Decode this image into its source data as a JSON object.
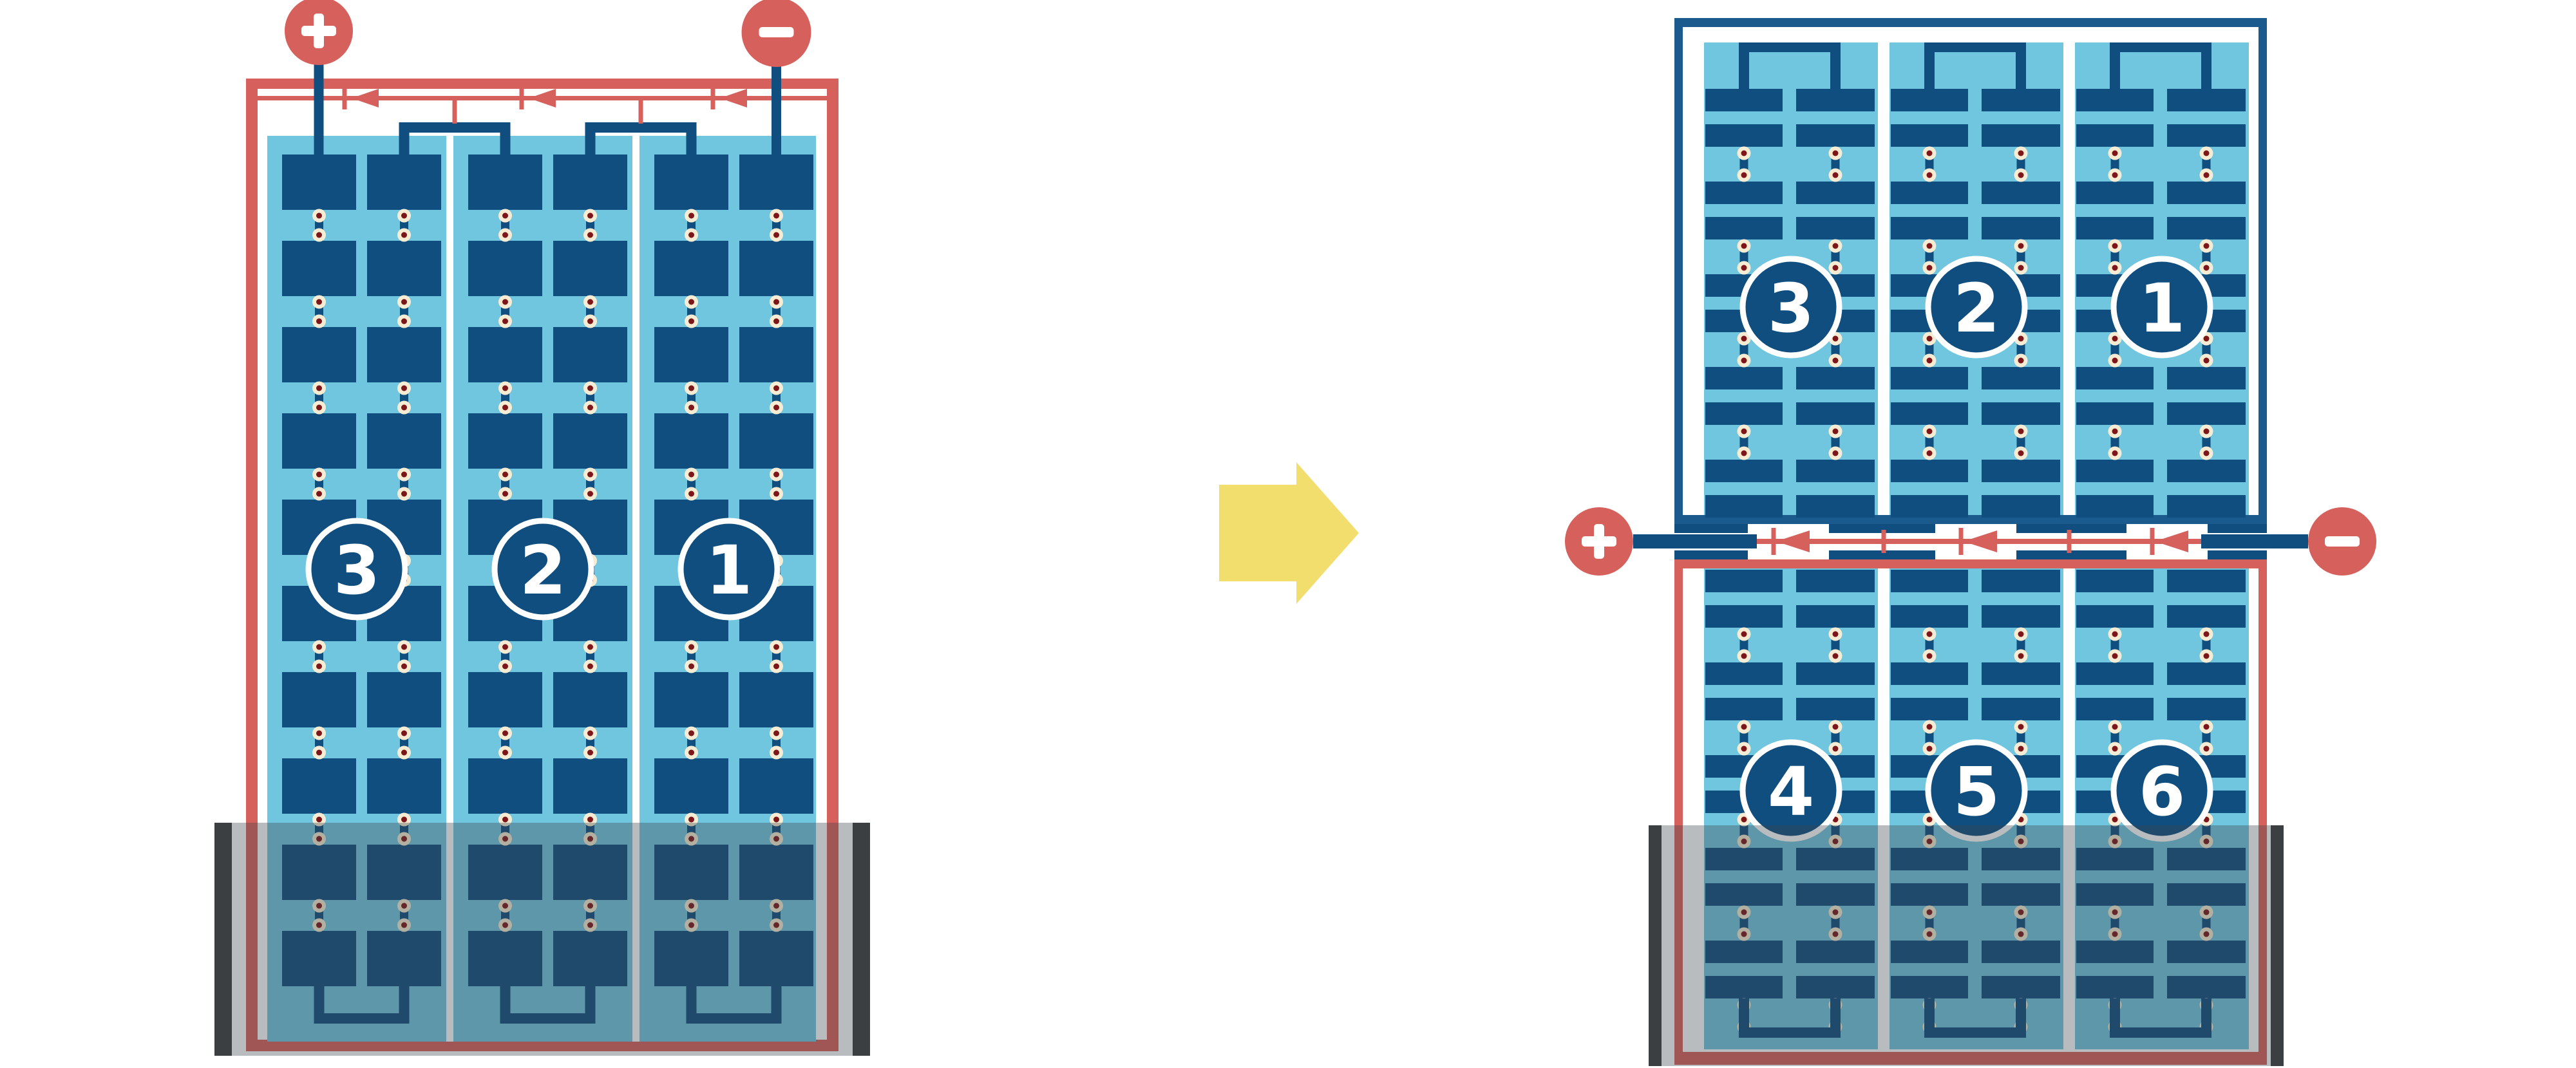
{
  "figure": {
    "description": "Comparison of a full-cell solar module and a half-cut-cell solar module under partial bottom shading",
    "colors": {
      "red": "#D6605C",
      "navy": "#0F4E7E",
      "frame_navy": "#1B5A8C",
      "light_blue": "#70C6DF",
      "cream": "#F6ECD3",
      "maroon": "#7D1619",
      "white": "#FFFFFF",
      "shade": "rgba(62,70,74,0.36)",
      "shade_bar": "#3B3F41",
      "yellow": "#F2DE6C"
    },
    "left_module": {
      "kind": "full-cell module",
      "frame_color_name": "red",
      "terminals": [
        {
          "sign": "+"
        },
        {
          "sign": "−"
        }
      ],
      "bypass_diode_count": 3,
      "strings": [
        {
          "number": "3"
        },
        {
          "number": "2"
        },
        {
          "number": "1"
        }
      ],
      "columns_per_string": 2,
      "cells_per_column": 10,
      "shaded_bottom": true
    },
    "transition_arrow": {
      "direction": "right"
    },
    "right_module": {
      "kind": "half-cut cell module (split in two halves with central junction)",
      "terminals": [
        {
          "sign": "+"
        },
        {
          "sign": "−"
        }
      ],
      "bypass_diode_count": 3,
      "top_half_strings": [
        {
          "number": "3"
        },
        {
          "number": "2"
        },
        {
          "number": "1"
        }
      ],
      "bottom_half_strings": [
        {
          "number": "4"
        },
        {
          "number": "5"
        },
        {
          "number": "6"
        }
      ],
      "columns_per_string": 2,
      "cells_per_column_per_half": 10,
      "shaded_bottom": true
    }
  }
}
